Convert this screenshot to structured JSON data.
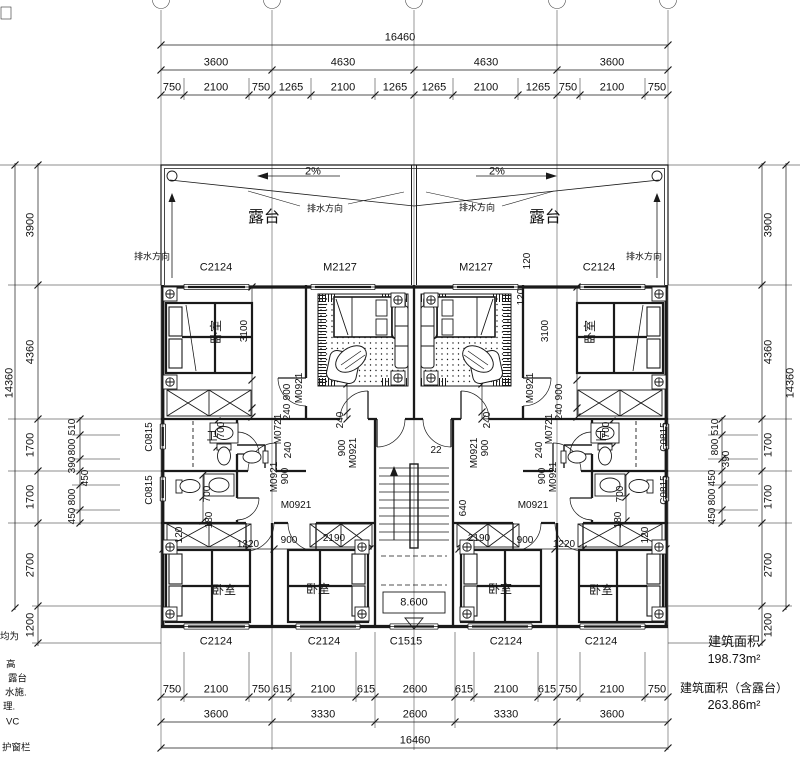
{
  "colors": {
    "line": "#1a1a1a",
    "background": "#ffffff"
  },
  "area": {
    "title1": "建筑面积",
    "value1": "198.73m²",
    "title2": "建筑面积（含露台）",
    "value2": "263.86m²"
  },
  "left_notes": [
    {
      "t": "均为",
      "x": 0,
      "y": 637
    },
    {
      "t": "高",
      "x": 6,
      "y": 665
    },
    {
      "t": "露台",
      "x": 8,
      "y": 679
    },
    {
      "t": "水施.",
      "x": 5,
      "y": 693
    },
    {
      "t": "理.",
      "x": 3,
      "y": 707
    },
    {
      "t": "VC",
      "x": 6,
      "y": 722
    },
    {
      "t": "护窗栏",
      "x": 2,
      "y": 748
    }
  ],
  "labels": [
    {
      "t": "16460",
      "x": 400,
      "y": 38
    },
    {
      "t": "3600",
      "x": 216,
      "y": 63
    },
    {
      "t": "4630",
      "x": 343,
      "y": 63
    },
    {
      "t": "4630",
      "x": 486,
      "y": 63
    },
    {
      "t": "3600",
      "x": 612,
      "y": 63
    },
    {
      "t": "750",
      "x": 172,
      "y": 88
    },
    {
      "t": "2100",
      "x": 216,
      "y": 88
    },
    {
      "t": "750",
      "x": 261,
      "y": 88
    },
    {
      "t": "1265",
      "x": 291,
      "y": 88
    },
    {
      "t": "2100",
      "x": 343,
      "y": 88
    },
    {
      "t": "1265",
      "x": 395,
      "y": 88
    },
    {
      "t": "1265",
      "x": 434,
      "y": 88
    },
    {
      "t": "2100",
      "x": 486,
      "y": 88
    },
    {
      "t": "1265",
      "x": 538,
      "y": 88
    },
    {
      "t": "750",
      "x": 568,
      "y": 88
    },
    {
      "t": "2100",
      "x": 612,
      "y": 88
    },
    {
      "t": "750",
      "x": 657,
      "y": 88
    },
    {
      "t": "750",
      "x": 172,
      "y": 690
    },
    {
      "t": "2100",
      "x": 216,
      "y": 690
    },
    {
      "t": "750",
      "x": 261,
      "y": 690
    },
    {
      "t": "615",
      "x": 282,
      "y": 690
    },
    {
      "t": "2100",
      "x": 323,
      "y": 690
    },
    {
      "t": "615",
      "x": 366,
      "y": 690
    },
    {
      "t": "2600",
      "x": 415,
      "y": 690
    },
    {
      "t": "615",
      "x": 464,
      "y": 690
    },
    {
      "t": "2100",
      "x": 506,
      "y": 690
    },
    {
      "t": "615",
      "x": 547,
      "y": 690
    },
    {
      "t": "750",
      "x": 568,
      "y": 690
    },
    {
      "t": "2100",
      "x": 612,
      "y": 690
    },
    {
      "t": "750",
      "x": 657,
      "y": 690
    },
    {
      "t": "3600",
      "x": 216,
      "y": 715
    },
    {
      "t": "3330",
      "x": 323,
      "y": 715
    },
    {
      "t": "2600",
      "x": 415,
      "y": 715
    },
    {
      "t": "3330",
      "x": 506,
      "y": 715
    },
    {
      "t": "3600",
      "x": 612,
      "y": 715
    },
    {
      "t": "16460",
      "x": 415,
      "y": 741
    },
    {
      "t": "14360",
      "x": 10,
      "y": 383,
      "r": -90
    },
    {
      "t": "3900",
      "x": 31,
      "y": 225,
      "r": -90
    },
    {
      "t": "4360",
      "x": 31,
      "y": 352,
      "r": -90
    },
    {
      "t": "1700",
      "x": 31,
      "y": 445,
      "r": -90
    },
    {
      "t": "1700",
      "x": 31,
      "y": 497,
      "r": -90
    },
    {
      "t": "2700",
      "x": 31,
      "y": 565,
      "r": -90
    },
    {
      "t": "1200",
      "x": 31,
      "y": 625,
      "r": -90
    },
    {
      "t": "510",
      "x": 73,
      "y": 427,
      "r": -90,
      "s": 10
    },
    {
      "t": "800",
      "x": 73,
      "y": 447,
      "r": -90,
      "s": 10
    },
    {
      "t": "390",
      "x": 73,
      "y": 465,
      "r": -90,
      "s": 10
    },
    {
      "t": "450",
      "x": 86,
      "y": 478,
      "r": -90,
      "s": 10
    },
    {
      "t": "800",
      "x": 73,
      "y": 497,
      "r": -90,
      "s": 10
    },
    {
      "t": "450",
      "x": 73,
      "y": 516,
      "r": -90,
      "s": 10
    },
    {
      "t": "14360",
      "x": 791,
      "y": 383,
      "r": -90
    },
    {
      "t": "3900",
      "x": 769,
      "y": 225,
      "r": -90
    },
    {
      "t": "4360",
      "x": 769,
      "y": 352,
      "r": -90
    },
    {
      "t": "1700",
      "x": 769,
      "y": 445,
      "r": -90
    },
    {
      "t": "1700",
      "x": 769,
      "y": 497,
      "r": -90
    },
    {
      "t": "2700",
      "x": 769,
      "y": 565,
      "r": -90
    },
    {
      "t": "1200",
      "x": 769,
      "y": 625,
      "r": -90
    },
    {
      "t": "510",
      "x": 716,
      "y": 427,
      "r": -90,
      "s": 10
    },
    {
      "t": "800",
      "x": 716,
      "y": 447,
      "r": -90,
      "s": 10
    },
    {
      "t": "390",
      "x": 727,
      "y": 459,
      "r": -90,
      "s": 10
    },
    {
      "t": "450",
      "x": 713,
      "y": 478,
      "r": -90,
      "s": 10
    },
    {
      "t": "800",
      "x": 713,
      "y": 497,
      "r": -90,
      "s": 10
    },
    {
      "t": "450",
      "x": 713,
      "y": 516,
      "r": -90,
      "s": 10
    },
    {
      "t": "C2124",
      "x": 216,
      "y": 268
    },
    {
      "t": "M2127",
      "x": 340,
      "y": 268
    },
    {
      "t": "M2127",
      "x": 476,
      "y": 268
    },
    {
      "t": "C2124",
      "x": 599,
      "y": 268
    },
    {
      "t": "120",
      "x": 528,
      "y": 261,
      "r": -90,
      "s": 10
    },
    {
      "t": "120",
      "x": 522,
      "y": 297,
      "r": -90,
      "s": 10
    },
    {
      "t": "C2124",
      "x": 216,
      "y": 642
    },
    {
      "t": "C2124",
      "x": 324,
      "y": 642
    },
    {
      "t": "C1515",
      "x": 406,
      "y": 642
    },
    {
      "t": "C2124",
      "x": 506,
      "y": 642
    },
    {
      "t": "C2124",
      "x": 601,
      "y": 642
    },
    {
      "t": "C0815",
      "x": 150,
      "y": 437,
      "r": -90,
      "s": 10
    },
    {
      "t": "C0815",
      "x": 150,
      "y": 490,
      "r": -90,
      "s": 10
    },
    {
      "t": "C0815",
      "x": 665,
      "y": 437,
      "r": -90,
      "s": 10
    },
    {
      "t": "C0815",
      "x": 665,
      "y": 490,
      "r": -90,
      "s": 10
    },
    {
      "t": "露台",
      "x": 264,
      "y": 218,
      "s": 16
    },
    {
      "t": "露台",
      "x": 545,
      "y": 218,
      "s": 16
    },
    {
      "t": "2%",
      "x": 313,
      "y": 172,
      "s": 11
    },
    {
      "t": "2%",
      "x": 497,
      "y": 172,
      "s": 11
    },
    {
      "t": "排水方向",
      "x": 325,
      "y": 209,
      "s": 9
    },
    {
      "t": "排水方向",
      "x": 477,
      "y": 208,
      "s": 9
    },
    {
      "t": "排水方向",
      "x": 152,
      "y": 257,
      "s": 9
    },
    {
      "t": "排水方向",
      "x": 644,
      "y": 257,
      "s": 9
    },
    {
      "t": "卧室",
      "x": 216,
      "y": 332,
      "r": -90,
      "s": 12
    },
    {
      "t": "卧室",
      "x": 590,
      "y": 332,
      "r": -90,
      "s": 12
    },
    {
      "t": "卧室",
      "x": 224,
      "y": 590,
      "s": 12
    },
    {
      "t": "卧室",
      "x": 318,
      "y": 589,
      "s": 12
    },
    {
      "t": "卧室",
      "x": 500,
      "y": 589,
      "s": 12
    },
    {
      "t": "卧室",
      "x": 601,
      "y": 590,
      "s": 12
    },
    {
      "t": "卫",
      "x": 212,
      "y": 437,
      "s": 11
    },
    {
      "t": "卫",
      "x": 601,
      "y": 437,
      "s": 11
    },
    {
      "t": "3100",
      "x": 245,
      "y": 331,
      "r": -90,
      "s": 10
    },
    {
      "t": "3100",
      "x": 546,
      "y": 331,
      "r": -90,
      "s": 10
    },
    {
      "t": "900",
      "x": 288,
      "y": 392,
      "r": -90,
      "s": 10
    },
    {
      "t": "240",
      "x": 288,
      "y": 412,
      "r": -90,
      "s": 10
    },
    {
      "t": "M0921",
      "x": 300,
      "y": 388,
      "r": -90,
      "s": 10
    },
    {
      "t": "900",
      "x": 560,
      "y": 392,
      "r": -90,
      "s": 10
    },
    {
      "t": "240",
      "x": 560,
      "y": 412,
      "r": -90,
      "s": 10
    },
    {
      "t": "M0921",
      "x": 531,
      "y": 388,
      "r": -90,
      "s": 10
    },
    {
      "t": "M0721",
      "x": 279,
      "y": 429,
      "r": -90,
      "s": 10
    },
    {
      "t": "240",
      "x": 289,
      "y": 450,
      "r": -90,
      "s": 10
    },
    {
      "t": "M0921",
      "x": 275,
      "y": 477,
      "r": -90,
      "s": 10
    },
    {
      "t": "900",
      "x": 286,
      "y": 476,
      "r": -90,
      "s": 10
    },
    {
      "t": "M0921",
      "x": 296,
      "y": 506,
      "s": 10
    },
    {
      "t": "M0721",
      "x": 550,
      "y": 429,
      "r": -90,
      "s": 10
    },
    {
      "t": "240",
      "x": 540,
      "y": 450,
      "r": -90,
      "s": 10
    },
    {
      "t": "M0921",
      "x": 554,
      "y": 477,
      "r": -90,
      "s": 10
    },
    {
      "t": "900",
      "x": 543,
      "y": 476,
      "r": -90,
      "s": 10
    },
    {
      "t": "M0921",
      "x": 533,
      "y": 506,
      "s": 10
    },
    {
      "t": "700",
      "x": 222,
      "y": 430,
      "r": -90,
      "s": 10
    },
    {
      "t": "700",
      "x": 208,
      "y": 494,
      "r": -90,
      "s": 10
    },
    {
      "t": "180",
      "x": 210,
      "y": 520,
      "r": -90,
      "s": 10
    },
    {
      "t": "700",
      "x": 607,
      "y": 430,
      "r": -90,
      "s": 10
    },
    {
      "t": "700",
      "x": 621,
      "y": 494,
      "r": -90,
      "s": 10
    },
    {
      "t": "180",
      "x": 619,
      "y": 520,
      "r": -90,
      "s": 10
    },
    {
      "t": "240",
      "x": 341,
      "y": 420,
      "r": -90,
      "s": 10
    },
    {
      "t": "900",
      "x": 343,
      "y": 448,
      "r": -90,
      "s": 10
    },
    {
      "t": "M0921",
      "x": 354,
      "y": 453,
      "r": -90,
      "s": 10
    },
    {
      "t": "240",
      "x": 488,
      "y": 420,
      "r": -90,
      "s": 10
    },
    {
      "t": "900",
      "x": 486,
      "y": 448,
      "r": -90,
      "s": 10
    },
    {
      "t": "M0921",
      "x": 475,
      "y": 453,
      "r": -90,
      "s": 10
    },
    {
      "t": "22",
      "x": 436,
      "y": 451,
      "s": 10
    },
    {
      "t": "640",
      "x": 464,
      "y": 508,
      "r": -90,
      "s": 10
    },
    {
      "t": "8.600",
      "x": 414,
      "y": 603,
      "s": 11
    },
    {
      "t": "120",
      "x": 180,
      "y": 535,
      "r": -90,
      "s": 10
    },
    {
      "t": "1220",
      "x": 248,
      "y": 545,
      "s": 10
    },
    {
      "t": "900",
      "x": 289,
      "y": 541,
      "s": 10
    },
    {
      "t": "2190",
      "x": 334,
      "y": 539,
      "s": 10
    },
    {
      "t": "2190",
      "x": 479,
      "y": 539,
      "s": 10
    },
    {
      "t": "900",
      "x": 525,
      "y": 541,
      "s": 10
    },
    {
      "t": "1220",
      "x": 564,
      "y": 545,
      "s": 10
    },
    {
      "t": "120",
      "x": 646,
      "y": 535,
      "r": -90,
      "s": 10
    }
  ]
}
